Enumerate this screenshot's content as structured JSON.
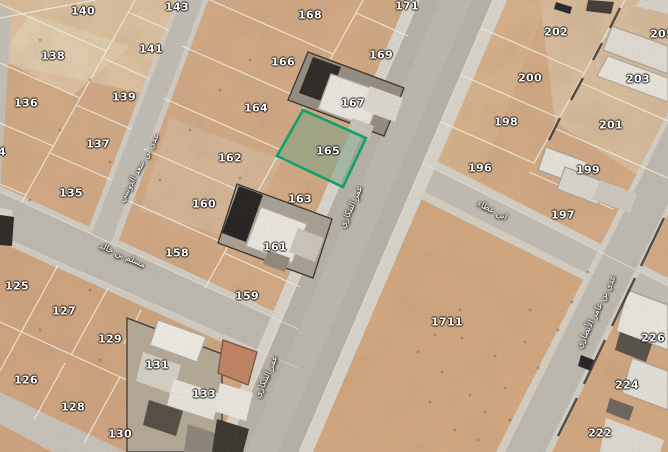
{
  "map": {
    "highlight_color": "#12a069",
    "highlighted_plot": {
      "text": "165"
    },
    "plot_labels": [
      {
        "text": "140",
        "x": 83,
        "y": 11
      },
      {
        "text": "143",
        "x": 177,
        "y": 7
      },
      {
        "text": "168",
        "x": 310,
        "y": 15
      },
      {
        "text": "171",
        "x": 407,
        "y": 6
      },
      {
        "text": "202",
        "x": 556,
        "y": 32
      },
      {
        "text": "205",
        "x": 662,
        "y": 34
      },
      {
        "text": "138",
        "x": 53,
        "y": 56
      },
      {
        "text": "141",
        "x": 151,
        "y": 49
      },
      {
        "text": "166",
        "x": 283,
        "y": 62
      },
      {
        "text": "169",
        "x": 381,
        "y": 55
      },
      {
        "text": "200",
        "x": 530,
        "y": 78
      },
      {
        "text": "203",
        "x": 638,
        "y": 79
      },
      {
        "text": "136",
        "x": 26,
        "y": 103
      },
      {
        "text": "139",
        "x": 124,
        "y": 97
      },
      {
        "text": "164",
        "x": 256,
        "y": 108
      },
      {
        "text": "167",
        "x": 353,
        "y": 103
      },
      {
        "text": "198",
        "x": 506,
        "y": 122
      },
      {
        "text": "201",
        "x": 611,
        "y": 125
      },
      {
        "text": "134",
        "x": -6,
        "y": 152
      },
      {
        "text": "137",
        "x": 98,
        "y": 144
      },
      {
        "text": "162",
        "x": 230,
        "y": 158
      },
      {
        "text": "165",
        "x": 328,
        "y": 151
      },
      {
        "text": "196",
        "x": 480,
        "y": 168
      },
      {
        "text": "199",
        "x": 588,
        "y": 170
      },
      {
        "text": "135",
        "x": 71,
        "y": 193
      },
      {
        "text": "160",
        "x": 204,
        "y": 204
      },
      {
        "text": "163",
        "x": 300,
        "y": 199
      },
      {
        "text": "197",
        "x": 563,
        "y": 215
      },
      {
        "text": "158",
        "x": 177,
        "y": 253
      },
      {
        "text": "161",
        "x": 275,
        "y": 247
      },
      {
        "text": "125",
        "x": 17,
        "y": 286
      },
      {
        "text": "159",
        "x": 247,
        "y": 296
      },
      {
        "text": "1711",
        "x": 447,
        "y": 322
      },
      {
        "text": "127",
        "x": 64,
        "y": 311
      },
      {
        "text": "129",
        "x": 110,
        "y": 339
      },
      {
        "text": "131",
        "x": 157,
        "y": 365
      },
      {
        "text": "133",
        "x": 204,
        "y": 394
      },
      {
        "text": "226",
        "x": 653,
        "y": 338
      },
      {
        "text": "126",
        "x": 26,
        "y": 380
      },
      {
        "text": "128",
        "x": 73,
        "y": 407
      },
      {
        "text": "224",
        "x": 627,
        "y": 385
      },
      {
        "text": "130",
        "x": 120,
        "y": 434
      },
      {
        "text": "222",
        "x": 600,
        "y": 433
      }
    ],
    "street_labels": [
      {
        "text": "عدي بن سعد الدوسي",
        "x": 140,
        "y": 168,
        "angle": -62
      },
      {
        "text": "مسلم بن خالد",
        "x": 122,
        "y": 256,
        "angle": 24
      },
      {
        "text": "عمر البنكاري",
        "x": 352,
        "y": 207,
        "angle": -66
      },
      {
        "text": "عمر البنكاري",
        "x": 267,
        "y": 377,
        "angle": -66
      },
      {
        "text": "ابن عطاء",
        "x": 492,
        "y": 211,
        "angle": 27
      },
      {
        "text": "عدي بن عامر الأنصاري",
        "x": 597,
        "y": 312,
        "angle": -64
      }
    ]
  }
}
